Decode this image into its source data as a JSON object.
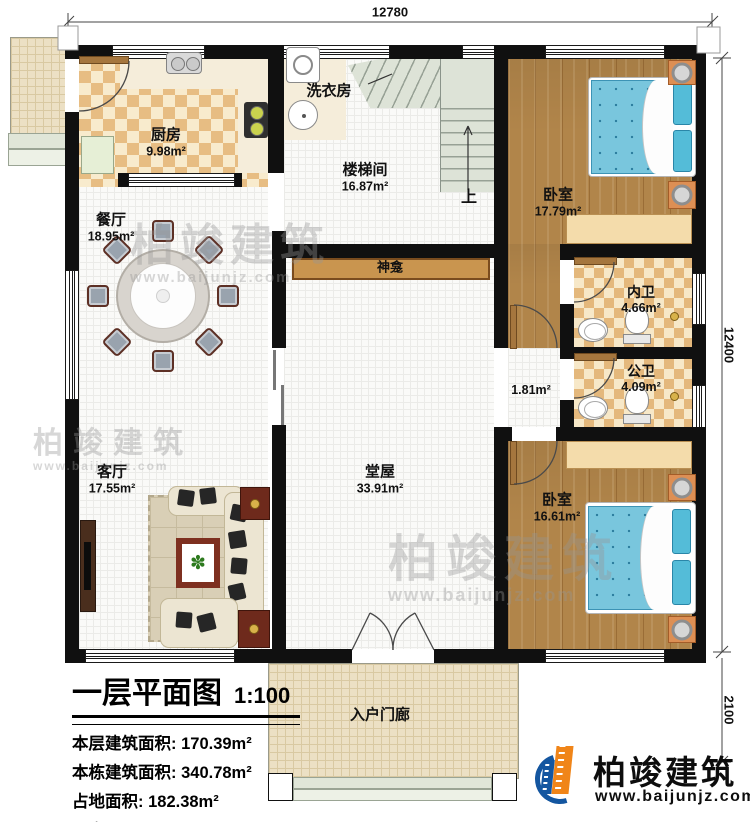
{
  "dims": {
    "top": "12780",
    "right": "12400",
    "porch": "2100"
  },
  "rooms": {
    "kitchen": {
      "name": "厨房",
      "area": "9.98m²"
    },
    "laundry": {
      "name": "洗衣房"
    },
    "stair": {
      "name": "楼梯间",
      "area": "16.87m²",
      "up": "上"
    },
    "dining": {
      "name": "餐厅",
      "area": "18.95m²"
    },
    "bedroom1": {
      "name": "卧室",
      "area": "17.79m²"
    },
    "ensuite": {
      "name": "内卫",
      "area": "4.66m²"
    },
    "bath": {
      "name": "公卫",
      "area": "4.09m²"
    },
    "corridor": {
      "area": "1.81m²"
    },
    "shrine": {
      "name": "神龛"
    },
    "hall": {
      "name": "堂屋",
      "area": "33.91m²"
    },
    "living": {
      "name": "客厅",
      "area": "17.55m²"
    },
    "bedroom2": {
      "name": "卧室",
      "area": "16.61m²"
    },
    "porch": {
      "name": "入户门廊"
    }
  },
  "titleblock": {
    "title": "一层平面图",
    "scale": "1:100",
    "rows": [
      {
        "label": "本层建筑面积:",
        "value": "170.39m²"
      },
      {
        "label": "本栋建筑面积:",
        "value": "340.78m²"
      },
      {
        "label": "占地面积:",
        "value": "182.38m²"
      },
      {
        "label": "层高:",
        "value": "3.7m"
      }
    ]
  },
  "branding": {
    "name": "柏竣建筑",
    "site": "www.baijunjz.com"
  },
  "watermark": {
    "name": "柏竣建筑",
    "site": "www.baijunjz.com"
  },
  "colors": {
    "wall": "#101010",
    "wood": "#b1854a",
    "checker_dark": "#e7bd83",
    "checker_light": "#f8ebcd",
    "bed_blue": "#79c6dd",
    "logo_blue": "#1456a0",
    "logo_orange": "#f08519"
  }
}
